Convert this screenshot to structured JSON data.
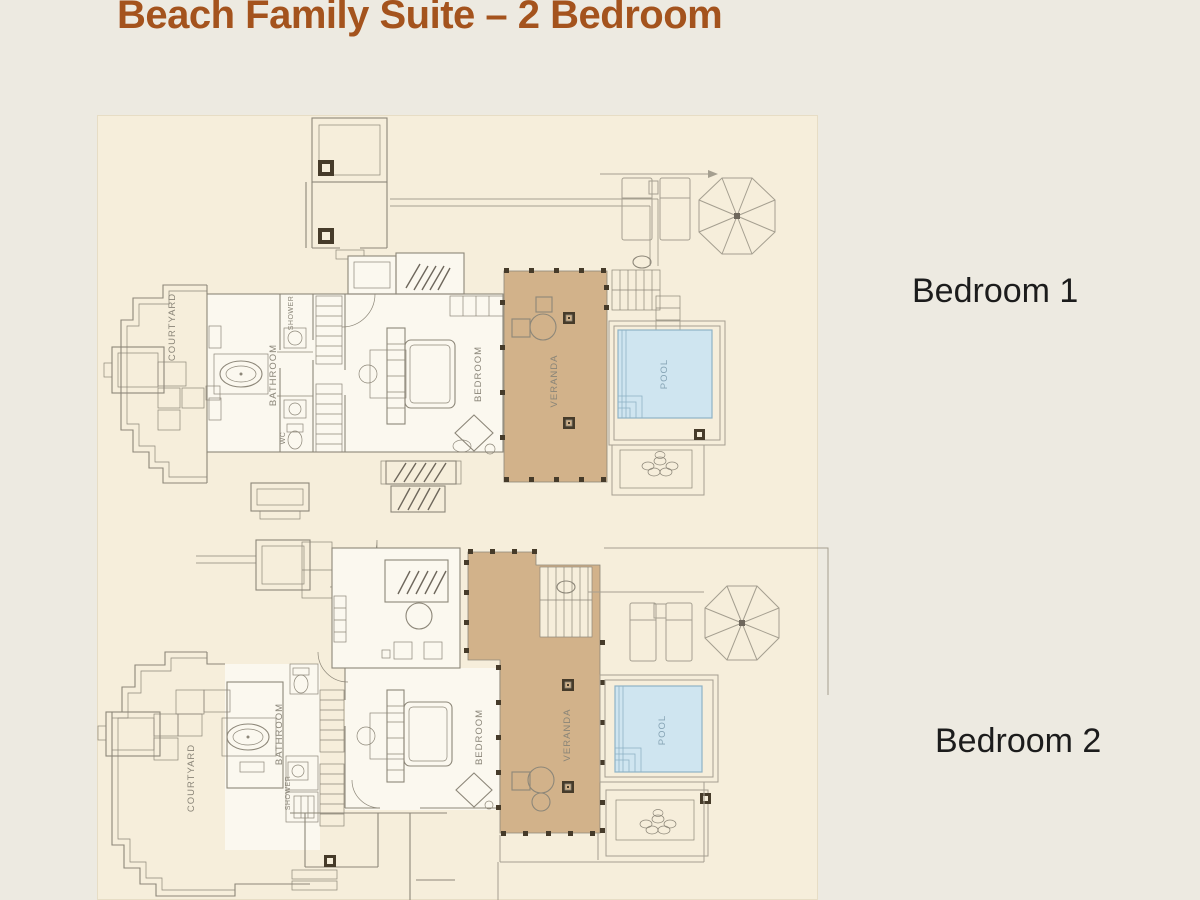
{
  "slide": {
    "title": "Beach Family Suite – 2 Bedroom"
  },
  "plans": [
    {
      "caption": "Bedroom 1",
      "rooms": {
        "courtyard": "COURTYARD",
        "bathroom": "BATHROOM",
        "shower": "SHOWER",
        "wc": "WC",
        "bedroom": "BEDROOM",
        "veranda": "VERANDA",
        "pool": "POOL"
      }
    },
    {
      "caption": "Bedroom 2",
      "rooms": {
        "courtyard": "COURTYARD",
        "bathroom": "BATHROOM",
        "shower": "SHOWER",
        "bedroom": "BEDROOM",
        "veranda": "VERANDA",
        "pool": "POOL"
      }
    }
  ],
  "colors": {
    "outer_bg": "#edeae1",
    "panel_bg": "#f6eedb",
    "title": "#a4531d",
    "wall": "#8d8779",
    "wall_light": "#a59f90",
    "room_fill": "#fbf8ef",
    "veranda": "#d2b28a",
    "veranda_post": "#463b2a",
    "pool_water": "#cfe5f0",
    "pool_line": "#8fb3c6",
    "pool_label": "#85a3b4",
    "plan_label": "#8a8578",
    "caption": "#1c1c1c"
  }
}
